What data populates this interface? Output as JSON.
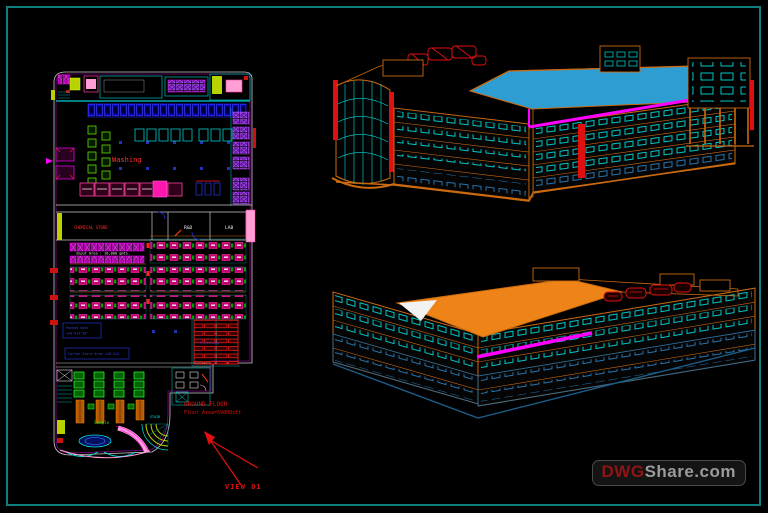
{
  "drawing": {
    "background": "#000000",
    "border_color": "#0d7f7f"
  },
  "floor_plan": {
    "washing_label": "Washing",
    "rooms": {
      "chemical_store": "CHEMICAL STORE",
      "rnd": "R&D",
      "lab": "LAB"
    },
    "input_area_label": "Input Area : 10,000 gmts.",
    "finishing_label": "Finishing",
    "sample_label": "Sample",
    "stair_label": "STAIR",
    "note1_line1": "Packed Gmts",
    "note1_line2": "=20'X14'X8'",
    "note2": "Carton Store Area =20'X14'",
    "title": "GROUND FLOOR",
    "area": "Floor Area=59800sft",
    "view_label": "VIEW 01"
  },
  "watermark": {
    "prefix": "DWG",
    "suffix": "Share.com"
  },
  "colors": {
    "magenta": "#ff00ff",
    "cyan": "#00e5e5",
    "cad_orange": "#cc6a10",
    "roof_blue": "#2e9ed2",
    "roof_orange": "#ee8418",
    "red": "#ff2020",
    "blue": "#2233cc",
    "green": "#33cc33",
    "purple": "#9b30e0",
    "pink": "#ff9fd6"
  }
}
